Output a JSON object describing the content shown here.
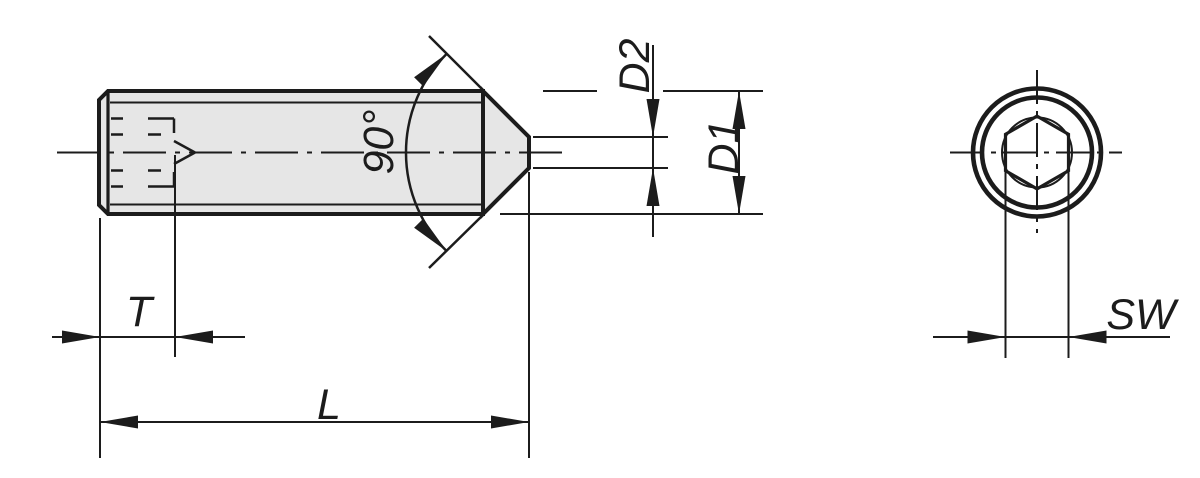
{
  "drawing": {
    "labels": {
      "cone_angle": "90°",
      "tip_diameter": "D2",
      "body_diameter": "D1",
      "socket_depth": "T",
      "screw_length": "L",
      "hex_key_size": "SW"
    },
    "colors": {
      "line": "#1c1c1c",
      "fill": "#e6e6e6",
      "background": "#ffffff"
    }
  }
}
